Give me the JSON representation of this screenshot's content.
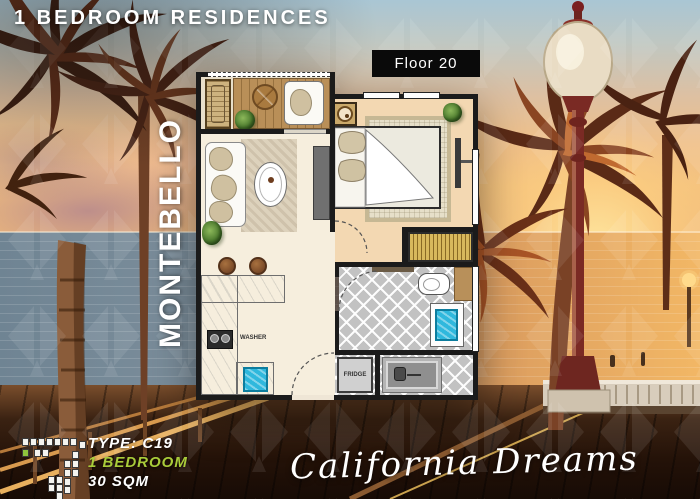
{
  "header": {
    "title": "1 BEDROOM RESIDENCES"
  },
  "floor_badge": {
    "label": "Floor 20"
  },
  "tower": {
    "name": "MONTEBELLO"
  },
  "floor_plan": {
    "appliance_labels": {
      "washer": "WASHER",
      "fridge": "FRIDGE"
    }
  },
  "unit_info": {
    "type": "TYPE: C19",
    "bedrooms": "1 BEDROOM",
    "area": "30 SQM"
  },
  "tagline": {
    "text": "California Dreams"
  },
  "key_plan": {
    "highlighted_unit_color": "#8fc43c",
    "icon": "building-footprint-key-plan"
  },
  "colors": {
    "accent_green": "#a9cb3a",
    "badge_bg": "#0a0a0a",
    "sink_blue": "#2fb8dd",
    "tile_gray": "#c2c2c2",
    "deck_wood": "#b98f58",
    "wardrobe_gold": "#c9a84c"
  }
}
